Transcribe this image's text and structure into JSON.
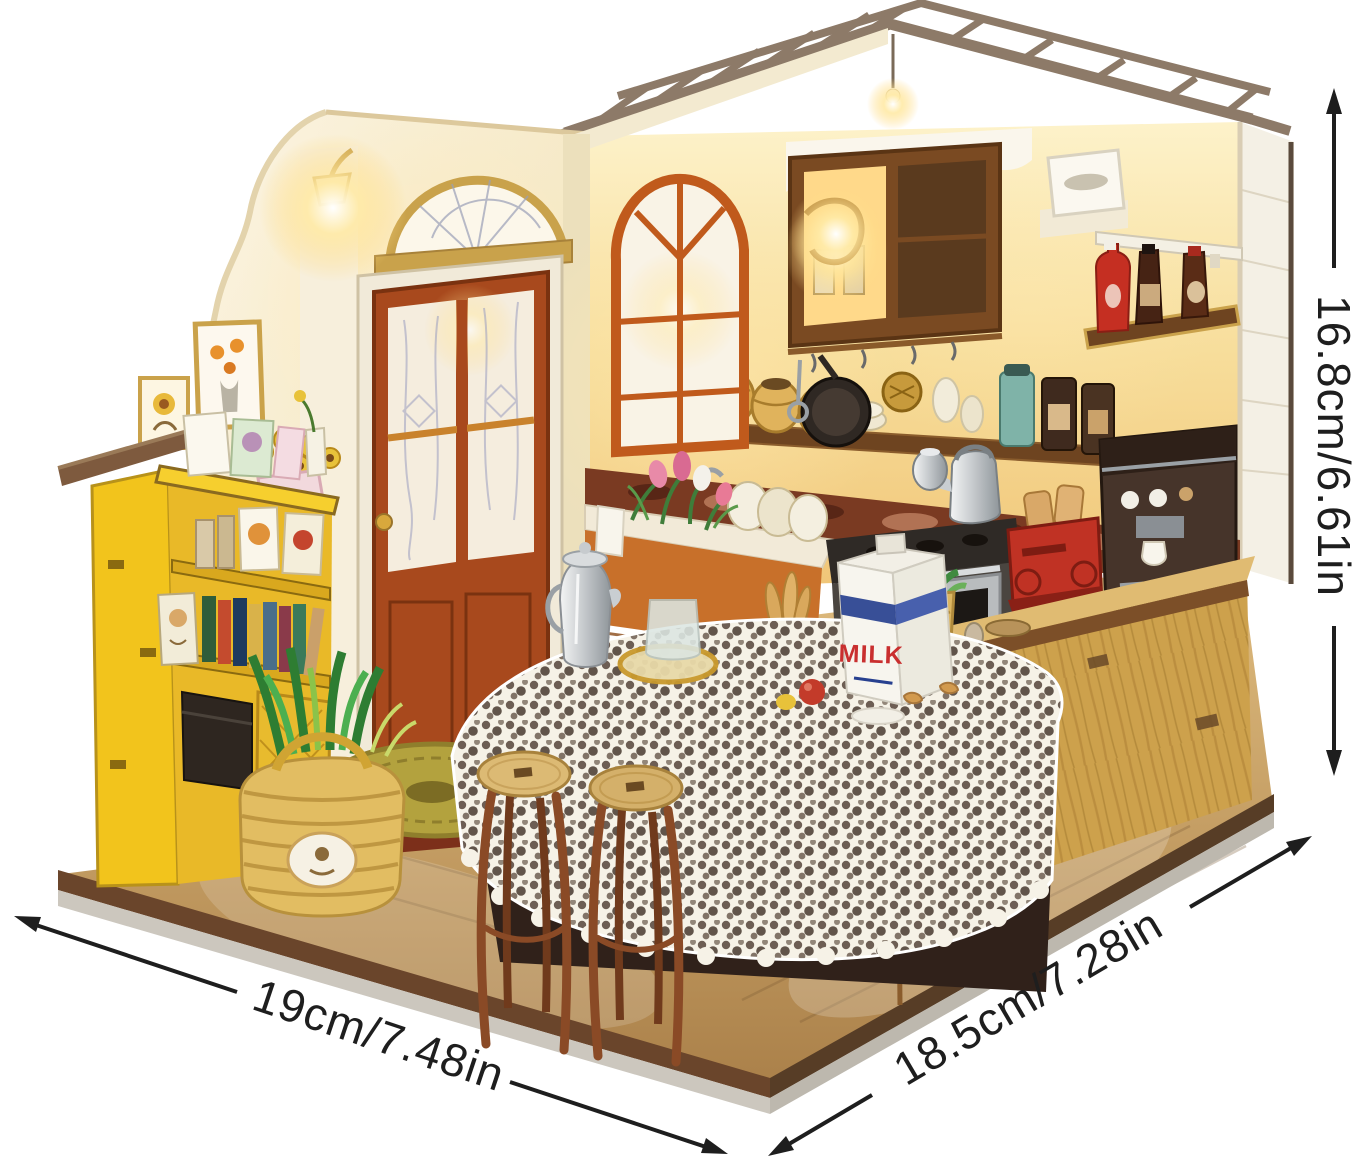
{
  "meta": {
    "description": "Product photo of a DIY miniature dollhouse kitchen kit shown on a white background with printed size arrows",
    "background_color": "#ffffff"
  },
  "dimensions": {
    "width": {
      "label": "19cm/7.48in"
    },
    "depth": {
      "label": "18.5cm/7.28in"
    },
    "height": {
      "label": "16.8cm/6.61in"
    }
  },
  "scene": {
    "milk_carton_text": "MILK",
    "palette": {
      "wall_cream": "#f7efda",
      "wall_yellow": "#f5dc96",
      "door_orange": "#a8491d",
      "window_frame_orange": "#c05a1c",
      "roof_beam": "#8d7a68",
      "bookshelf_yellow": "#f2c41c",
      "island_wood": "#cda14c",
      "floor_wood": "#c79a5a",
      "toaster_red": "#c03224",
      "platform_rim": "#6a452b",
      "platform_base_grey": "#c9c4bb",
      "dimension_line": "#1e1e1e"
    }
  }
}
